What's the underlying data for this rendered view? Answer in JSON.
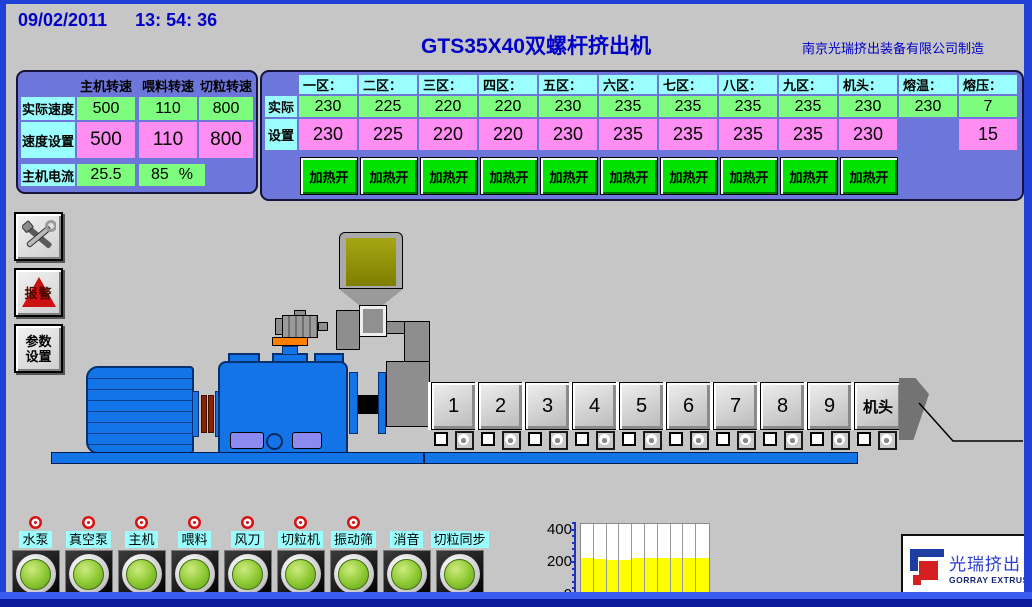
{
  "header": {
    "date": "09/02/2011",
    "time": "13: 54: 36",
    "title": "GTS35X40双螺杆挤出机",
    "manufacturer": "南京光瑞挤出装备有限公司制造"
  },
  "speed_panel": {
    "headers": [
      "主机转速",
      "喂料转速",
      "切粒转速"
    ],
    "actual_label": "实际速度",
    "actual_values": [
      "500",
      "110",
      "800"
    ],
    "set_label": "速度设置",
    "set_values": [
      "500",
      "110",
      "800"
    ],
    "current_label": "主机电流",
    "current_value": "25.5",
    "load_value": "85",
    "load_unit": "%"
  },
  "temp_panel": {
    "actual_label": "实际",
    "set_label": "设置",
    "heat_button_label": "加热开",
    "columns": [
      {
        "name": "一区：",
        "actual": "230",
        "set": "230",
        "heat": true
      },
      {
        "name": "二区：",
        "actual": "225",
        "set": "225",
        "heat": true
      },
      {
        "name": "三区：",
        "actual": "220",
        "set": "220",
        "heat": true
      },
      {
        "name": "四区：",
        "actual": "220",
        "set": "220",
        "heat": true
      },
      {
        "name": "五区：",
        "actual": "230",
        "set": "230",
        "heat": true
      },
      {
        "name": "六区：",
        "actual": "235",
        "set": "235",
        "heat": true
      },
      {
        "name": "七区：",
        "actual": "235",
        "set": "235",
        "heat": true
      },
      {
        "name": "八区：",
        "actual": "235",
        "set": "235",
        "heat": true
      },
      {
        "name": "九区：",
        "actual": "235",
        "set": "235",
        "heat": true
      },
      {
        "name": "机头：",
        "actual": "230",
        "set": "230",
        "heat": true
      },
      {
        "name": "熔温：",
        "actual": "230",
        "set": null,
        "heat": false
      },
      {
        "name": "熔压：",
        "actual": "7",
        "set": "15",
        "heat": false
      }
    ]
  },
  "sidebar": {
    "alarm_label": "报警",
    "params_label_line1": "参数",
    "params_label_line2": "设置"
  },
  "machine": {
    "zones": [
      "1",
      "2",
      "3",
      "4",
      "5",
      "6",
      "7",
      "8",
      "9"
    ],
    "die_label": "机头"
  },
  "indicators": [
    {
      "label": "水泵",
      "alarm": true
    },
    {
      "label": "真空泵",
      "alarm": true
    },
    {
      "label": "主机",
      "alarm": true
    },
    {
      "label": "喂料",
      "alarm": true
    },
    {
      "label": "风刀",
      "alarm": true
    },
    {
      "label": "切粒机",
      "alarm": true
    },
    {
      "label": "振动筛",
      "alarm": true
    },
    {
      "label": "消音",
      "alarm": false
    },
    {
      "label": "切粒同步",
      "alarm": false
    }
  ],
  "chart_data": {
    "type": "bar",
    "categories": [
      "一区",
      "二区",
      "三区",
      "四区",
      "五区",
      "六区",
      "七区",
      "八区",
      "九区",
      "机头"
    ],
    "values": [
      230,
      225,
      220,
      220,
      230,
      235,
      235,
      235,
      235,
      230
    ],
    "title": "",
    "xlabel": "",
    "ylabel": "",
    "yticks": [
      400,
      200,
      0
    ],
    "ylim": [
      0,
      440
    ],
    "bar_color": "#ffff00",
    "grid": true,
    "legend": false
  },
  "logo": {
    "cn": "光瑞挤出",
    "en": "GORRAY EXTRUSION"
  },
  "colors": {
    "accent_text": "#0000c8",
    "panel_purple": "#6d77db",
    "cell_cyan": "#9cffff",
    "cell_green": "#7dfc7d",
    "cell_pink": "#ff8df2",
    "heat_button_green": "#00e200",
    "machine_blue": "#1374e8",
    "bar_yellow": "#ffff00",
    "alarm_red": "#d51111"
  }
}
